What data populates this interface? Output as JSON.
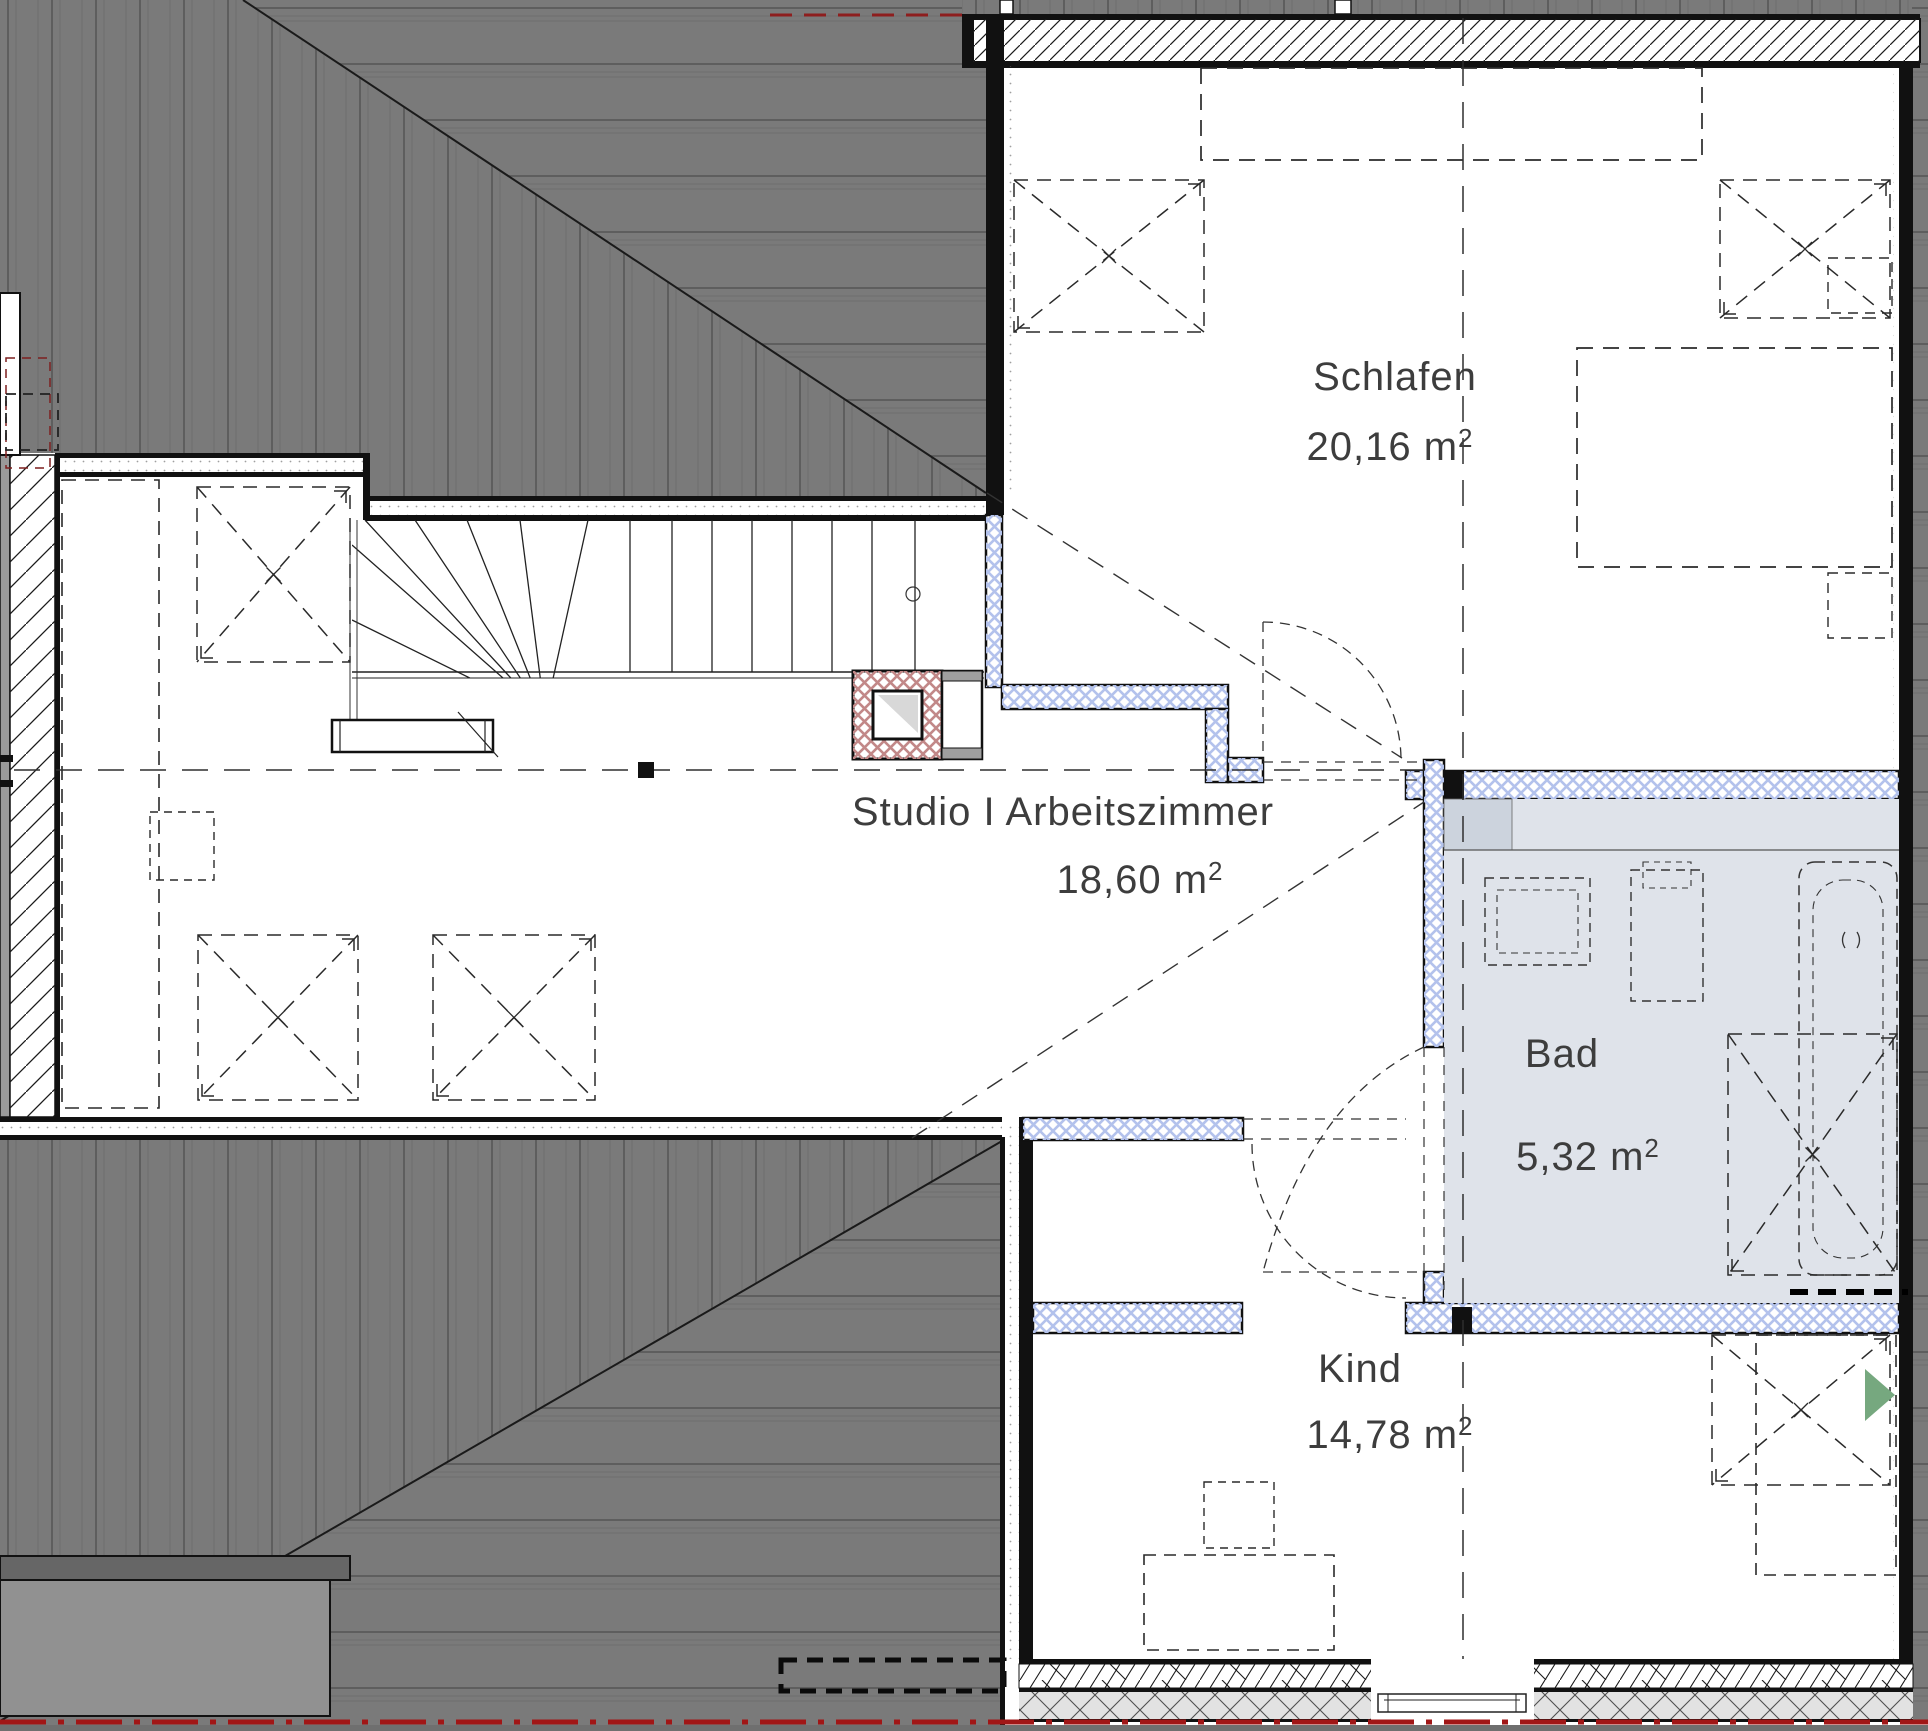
{
  "plan": {
    "type": "floor-plan",
    "floor": "Dachgeschoss",
    "rooms": [
      {
        "id": "schlafen",
        "name": "Schlafen",
        "area": "20,16",
        "unit": " m",
        "sup": "2"
      },
      {
        "id": "studio",
        "name": "Studio I Arbeitszimmer",
        "area": "18,60",
        "unit": " m",
        "sup": "2"
      },
      {
        "id": "bad",
        "name": "Bad",
        "area": "5,32",
        "unit": " m",
        "sup": "2"
      },
      {
        "id": "kind",
        "name": "Kind",
        "area": "14,78",
        "unit": " m",
        "sup": "2"
      }
    ],
    "colors": {
      "roof_gray": "#7a7a7a",
      "wall_black": "#111111",
      "insulation_blue": "#b3c2ec",
      "chimney_red": "#c28888",
      "bath_floor": "#dfe3ea",
      "section_line_red": "#a11616",
      "entrance_marker_green": "#76a87f"
    }
  }
}
